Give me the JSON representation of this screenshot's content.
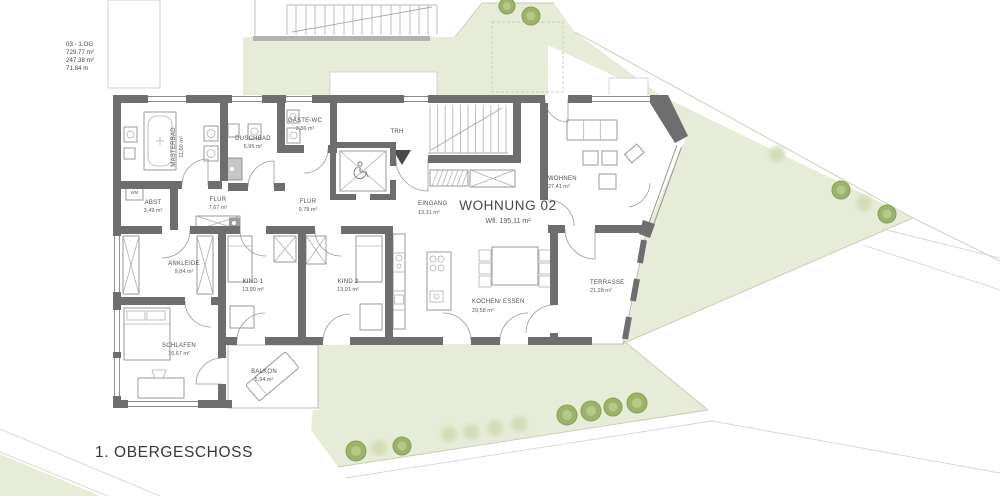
{
  "sheet": {
    "title": "1. OBERGESCHOSS"
  },
  "info_block": {
    "lines": [
      "03 - 1.OG",
      "729.77 m²",
      "247.38 m²",
      "71.84 m"
    ]
  },
  "apartment": {
    "name": "WOHNUNG 02",
    "area_label": "Wfl. 195,11 m²"
  },
  "rooms": [
    {
      "id": "masterbad",
      "label": "MASTERBAD",
      "area": "11,60 m²"
    },
    {
      "id": "duschbad",
      "label": "DUSCHBAD",
      "area": "6,95 m²"
    },
    {
      "id": "gaeste_wc",
      "label": "GÄSTE-WC",
      "area": "3,36 m²"
    },
    {
      "id": "trh",
      "label": "TRH",
      "area": ""
    },
    {
      "id": "abst",
      "label": "ABST",
      "area": "3,49 m²"
    },
    {
      "id": "flur_west",
      "label": "FLUR",
      "area": "7,67 m²"
    },
    {
      "id": "flur_mitte",
      "label": "FLUR",
      "area": "9,78 m²"
    },
    {
      "id": "eingang",
      "label": "EINGANG",
      "area": "13,31 m²"
    },
    {
      "id": "wohnen",
      "label": "WOHNEN",
      "area": "27,41 m²"
    },
    {
      "id": "ankleide",
      "label": "ANKLEIDE",
      "area": "9,84 m²"
    },
    {
      "id": "kind1",
      "label": "KIND 1",
      "area": "13,99 m²"
    },
    {
      "id": "kind2",
      "label": "KIND 2",
      "area": "13,91 m²"
    },
    {
      "id": "schlafen",
      "label": "SCHLAFEN",
      "area": "16,67 m²"
    },
    {
      "id": "kochen",
      "label": "KOCHEN/ ESSEN",
      "area": "29,58 m²"
    },
    {
      "id": "terrasse",
      "label": "TERRASSE",
      "area": "21,28 m²"
    },
    {
      "id": "balkon",
      "label": "BALKON",
      "area": "5,94 m²"
    }
  ],
  "fixtures": {
    "washing_machine": "WM"
  },
  "colors": {
    "site_green": "#e7ecd8",
    "wall": "#6e6e6e",
    "tree_dark": "#9cb36a",
    "tree_soft": "#d4ddb8",
    "text": "#4d4d4d"
  }
}
